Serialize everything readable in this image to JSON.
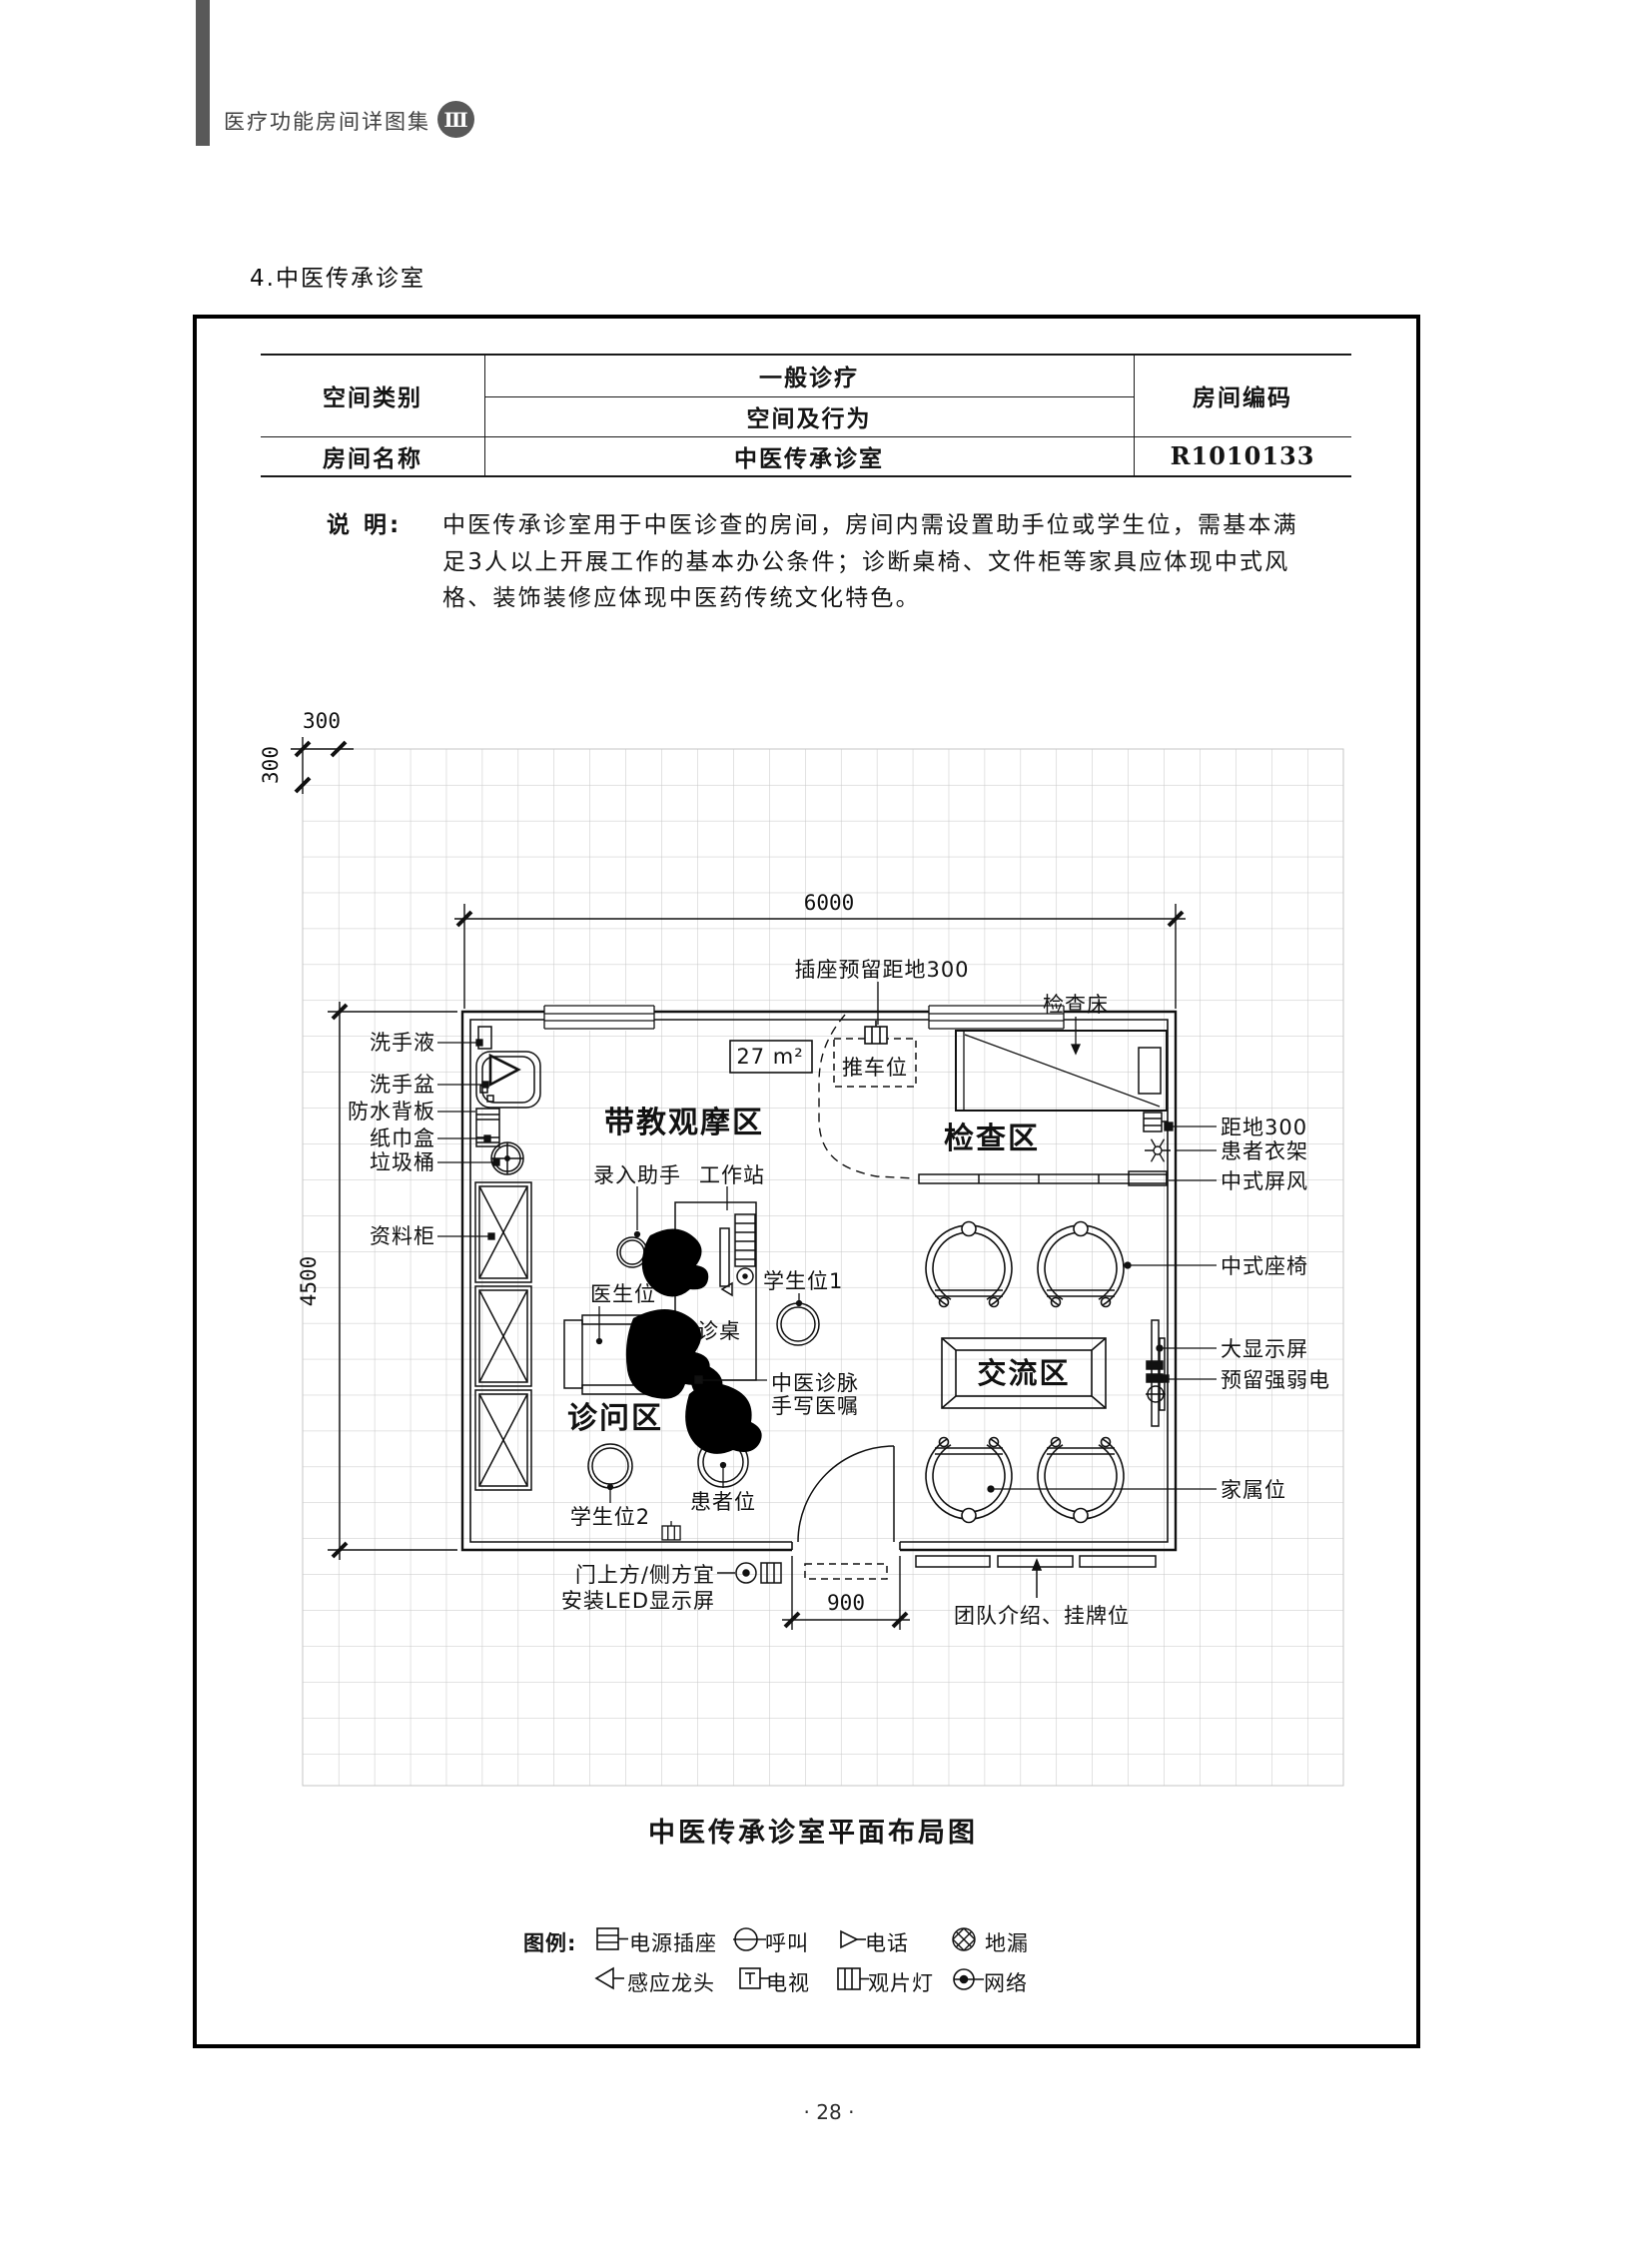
{
  "page": {
    "header": {
      "title": "医疗功能房间详图集",
      "volume": "Ⅲ"
    },
    "section_title": "4.中医传承诊室",
    "page_number": "· 28 ·"
  },
  "info_table": {
    "space_category_label": "空间类别",
    "space_category_line1": "一般诊疗",
    "space_category_line2": "空间及行为",
    "room_code_label": "房间编码",
    "room_name_label": "房间名称",
    "room_name": "中医传承诊室",
    "room_code": "R1010133"
  },
  "description": {
    "label": "说 明:",
    "lines": [
      "中医传承诊室用于中医诊查的房间，房间内需设置助手位或学生位，需基本满",
      "足3人以上开展工作的基本办公条件；诊断桌椅、文件柜等家具应体现中式风",
      "格、装饰装修应体现中医药传统文化特色。"
    ]
  },
  "plan": {
    "caption": "中医传承诊室平面布局图",
    "area": "27 m²",
    "dims": {
      "module_h": "300",
      "module_v": "300",
      "room_width": "6000",
      "room_depth": "4500",
      "door_width": "900"
    },
    "zones": {
      "teaching": "带教观摩区",
      "exam": "检查区",
      "consult": "诊问区",
      "communication": "交流区"
    },
    "labels": {
      "socket_height": "插座预留距地300",
      "exam_bed": "检查床",
      "cart": "推车位",
      "hand_soap": "洗手液",
      "wash_basin": "洗手盆",
      "waterproof_board": "防水背板",
      "tissue_box": "纸巾盒",
      "trash_bin": "垃圾桶",
      "file_cabinet": "资料柜",
      "entry_assistant": "录入助手",
      "workstation": "工作站",
      "doctor_seat": "医生位",
      "consult_desk": "诊桌",
      "student_seat_1": "学生位1",
      "student_seat_2": "学生位2",
      "patient_seat": "患者位",
      "pulse_note_line1": "中医诊脉",
      "pulse_note_line2": "手写医嘱",
      "height_300": "距地300",
      "patient_coat_rack": "患者衣架",
      "chinese_screen": "中式屏风",
      "chinese_chair": "中式座椅",
      "large_display": "大显示屏",
      "reserved_power": "预留强弱电",
      "family_seat": "家属位",
      "team_intro": "团队介绍、挂牌位",
      "led_line1": "门上方/侧方宜",
      "led_line2": "安装LED显示屏"
    }
  },
  "legend": {
    "title": "图例:",
    "row1": [
      {
        "icon": "power-socket-icon",
        "label": "电源插座"
      },
      {
        "icon": "call-icon",
        "label": "呼叫"
      },
      {
        "icon": "phone-icon",
        "label": "电话"
      },
      {
        "icon": "floor-drain-icon",
        "label": "地漏"
      }
    ],
    "row2": [
      {
        "icon": "sensor-faucet-icon",
        "label": "感应龙头"
      },
      {
        "icon": "tv-icon",
        "label": "电视"
      },
      {
        "icon": "film-viewer-icon",
        "label": "观片灯"
      },
      {
        "icon": "network-icon",
        "label": "网络"
      }
    ]
  }
}
